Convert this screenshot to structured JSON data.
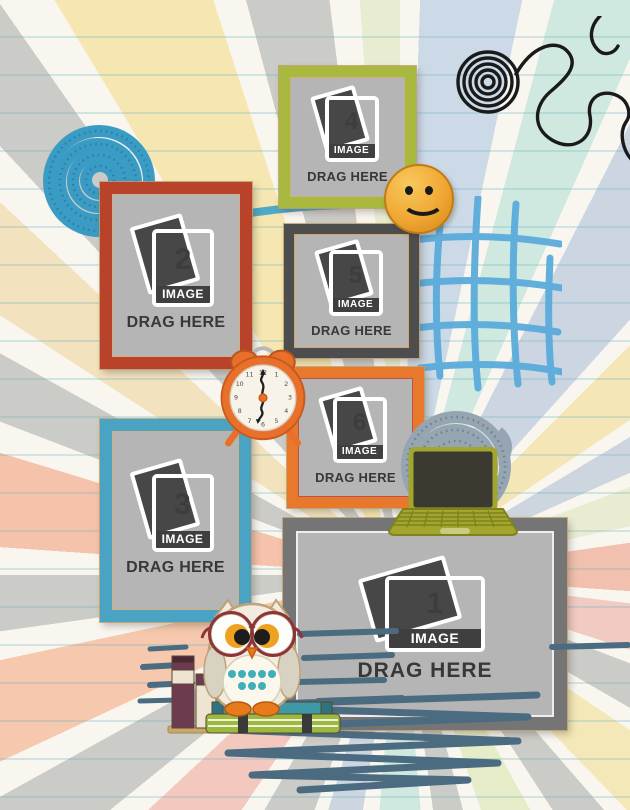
{
  "template": {
    "name": "scrapbook photo drop template",
    "placeholder_count": 6
  },
  "background": {
    "paper_color": "#f8f6ef",
    "ruled_line_color": "#8fc4cc",
    "ray_colors": [
      "#f2c0ae",
      "#cbcbc7",
      "#f6e7b2",
      "#cfe8e0",
      "#e8edd2",
      "#ccd6e2",
      "#f1cac2"
    ]
  },
  "frames": [
    {
      "number": "1",
      "image_label": "IMAGE",
      "drag_label": "DRAG HERE",
      "frame_color": "#757575",
      "orientation": "landscape"
    },
    {
      "number": "2",
      "image_label": "IMAGE",
      "drag_label": "DRAG HERE",
      "frame_color": "#b8432a",
      "orientation": "portrait"
    },
    {
      "number": "3",
      "image_label": "IMAGE",
      "drag_label": "DRAG HERE",
      "frame_color": "#4ba3c3",
      "orientation": "portrait"
    },
    {
      "number": "4",
      "image_label": "IMAGE",
      "drag_label": "DRAG HERE",
      "frame_color": "#a9b83e",
      "orientation": "square"
    },
    {
      "number": "5",
      "image_label": "IMAGE",
      "drag_label": "DRAG HERE",
      "frame_color": "#4d4d4d",
      "orientation": "square"
    },
    {
      "number": "6",
      "image_label": "IMAGE",
      "drag_label": "DRAG HERE",
      "frame_color": "#e8792c",
      "orientation": "square"
    }
  ],
  "decorations": {
    "clock": {
      "numerals": [
        "12",
        "1",
        "2",
        "3",
        "4",
        "5",
        "6",
        "7",
        "8",
        "9",
        "10",
        "11"
      ],
      "body_color": "#e8702a"
    },
    "smiley": {
      "face_color": "#f0a733"
    },
    "ropes": {
      "blue_coil": "#3a9cc4",
      "gray_coil": "#96a5b2"
    },
    "wire_doodle_color": "#1a1a1a",
    "crosshatch_color": "#57aadb",
    "scribble_color": "#4b6b80",
    "laptop": {
      "body": "#a3a62c",
      "screen": "#3a3a30"
    },
    "owl": {
      "body": "#f2ecdf",
      "glasses": "#8e3436",
      "belly_dots": "#3fb0b8",
      "feet": "#e87a1e"
    }
  }
}
